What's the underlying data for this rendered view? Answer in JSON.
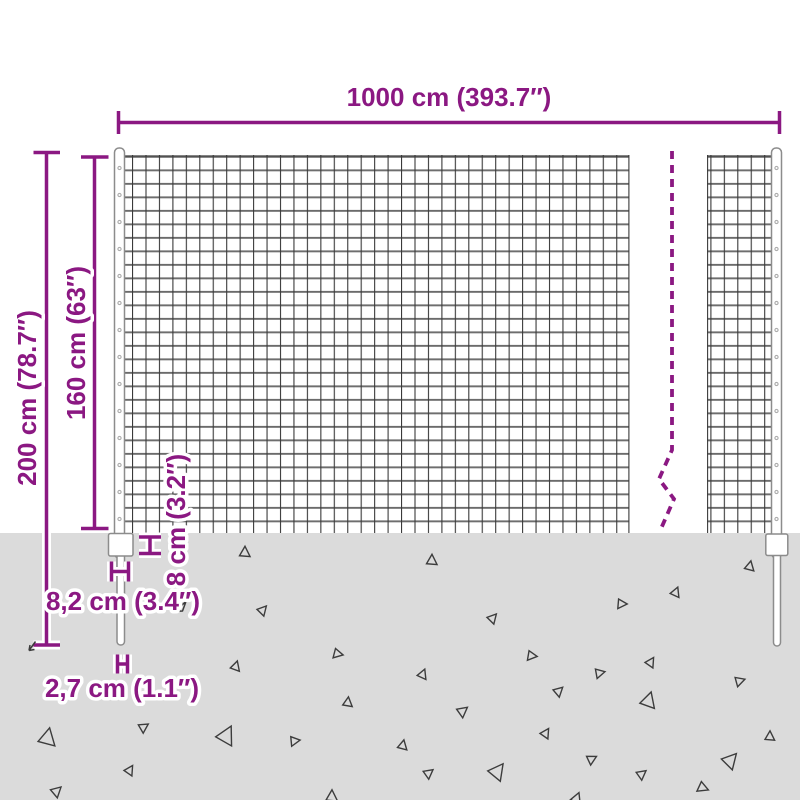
{
  "diagram": {
    "type": "product-dimension-diagram",
    "subject": "wire mesh fence with posts",
    "dimensions": {
      "total_width": {
        "label": "1000 cm (393.7″)",
        "value_cm": 1000,
        "value_in": 393.7
      },
      "total_height": {
        "label": "200 cm (78.7″)",
        "value_cm": 200,
        "value_in": 78.7
      },
      "mesh_height": {
        "label": "160 cm (63″)",
        "value_cm": 160,
        "value_in": 63
      },
      "plate_height": {
        "label": "8 cm (3.2″)",
        "value_cm": 8,
        "value_in": 3.2
      },
      "plate_width": {
        "label": "8,2 cm (3.4″)",
        "value_cm": 8.2,
        "value_in": 3.4
      },
      "post_diameter": {
        "label": "2,7 cm (1.1″)",
        "value_cm": 2.7,
        "value_in": 1.1
      }
    },
    "colors": {
      "accent": "#8B1882",
      "ground": "#DBDBDB",
      "wire_vertical": "#3A3A3A",
      "wire_horizontal": "#6B6B6B",
      "post_outline": "#8C8C8C"
    },
    "ground": {
      "triangles": [
        {
          "x": 245,
          "y": 552,
          "s": 11,
          "r": 0
        },
        {
          "x": 263,
          "y": 610,
          "s": 10,
          "r": 40
        },
        {
          "x": 338,
          "y": 654,
          "s": 10,
          "r": 100
        },
        {
          "x": 236,
          "y": 666,
          "s": 10,
          "r": 15
        },
        {
          "x": 348,
          "y": 702,
          "s": 10,
          "r": 5
        },
        {
          "x": 48,
          "y": 737,
          "s": 18,
          "r": 10
        },
        {
          "x": 144,
          "y": 727,
          "s": 10,
          "r": 55
        },
        {
          "x": 227,
          "y": 735,
          "s": 19,
          "r": 25
        },
        {
          "x": 295,
          "y": 741,
          "s": 10,
          "r": 80
        },
        {
          "x": 130,
          "y": 770,
          "s": 10,
          "r": 30
        },
        {
          "x": 57,
          "y": 791,
          "s": 11,
          "r": 45
        },
        {
          "x": 332,
          "y": 796,
          "s": 12,
          "r": 0
        },
        {
          "x": 432,
          "y": 560,
          "s": 11,
          "r": 0
        },
        {
          "x": 493,
          "y": 618,
          "s": 10,
          "r": 40
        },
        {
          "x": 532,
          "y": 656,
          "s": 10,
          "r": 95
        },
        {
          "x": 423,
          "y": 674,
          "s": 10,
          "r": 20
        },
        {
          "x": 600,
          "y": 673,
          "s": 10,
          "r": 75
        },
        {
          "x": 559,
          "y": 691,
          "s": 10,
          "r": 45
        },
        {
          "x": 463,
          "y": 711,
          "s": 11,
          "r": 50
        },
        {
          "x": 546,
          "y": 733,
          "s": 10,
          "r": 30
        },
        {
          "x": 403,
          "y": 745,
          "s": 10,
          "r": 10
        },
        {
          "x": 592,
          "y": 759,
          "s": 10,
          "r": 60
        },
        {
          "x": 429,
          "y": 773,
          "s": 10,
          "r": 50
        },
        {
          "x": 498,
          "y": 771,
          "s": 17,
          "r": 35
        },
        {
          "x": 577,
          "y": 798,
          "s": 11,
          "r": 20
        },
        {
          "x": 750,
          "y": 566,
          "s": 10,
          "r": 10
        },
        {
          "x": 676,
          "y": 592,
          "s": 10,
          "r": 20
        },
        {
          "x": 622,
          "y": 604,
          "s": 10,
          "r": 90
        },
        {
          "x": 651,
          "y": 662,
          "s": 10,
          "r": 30
        },
        {
          "x": 740,
          "y": 681,
          "s": 10,
          "r": 70
        },
        {
          "x": 649,
          "y": 700,
          "s": 16,
          "r": 15
        },
        {
          "x": 770,
          "y": 736,
          "s": 10,
          "r": 0
        },
        {
          "x": 731,
          "y": 760,
          "s": 16,
          "r": 40
        },
        {
          "x": 642,
          "y": 774,
          "s": 10,
          "r": 50
        },
        {
          "x": 703,
          "y": 788,
          "s": 11,
          "r": 110
        }
      ]
    }
  }
}
